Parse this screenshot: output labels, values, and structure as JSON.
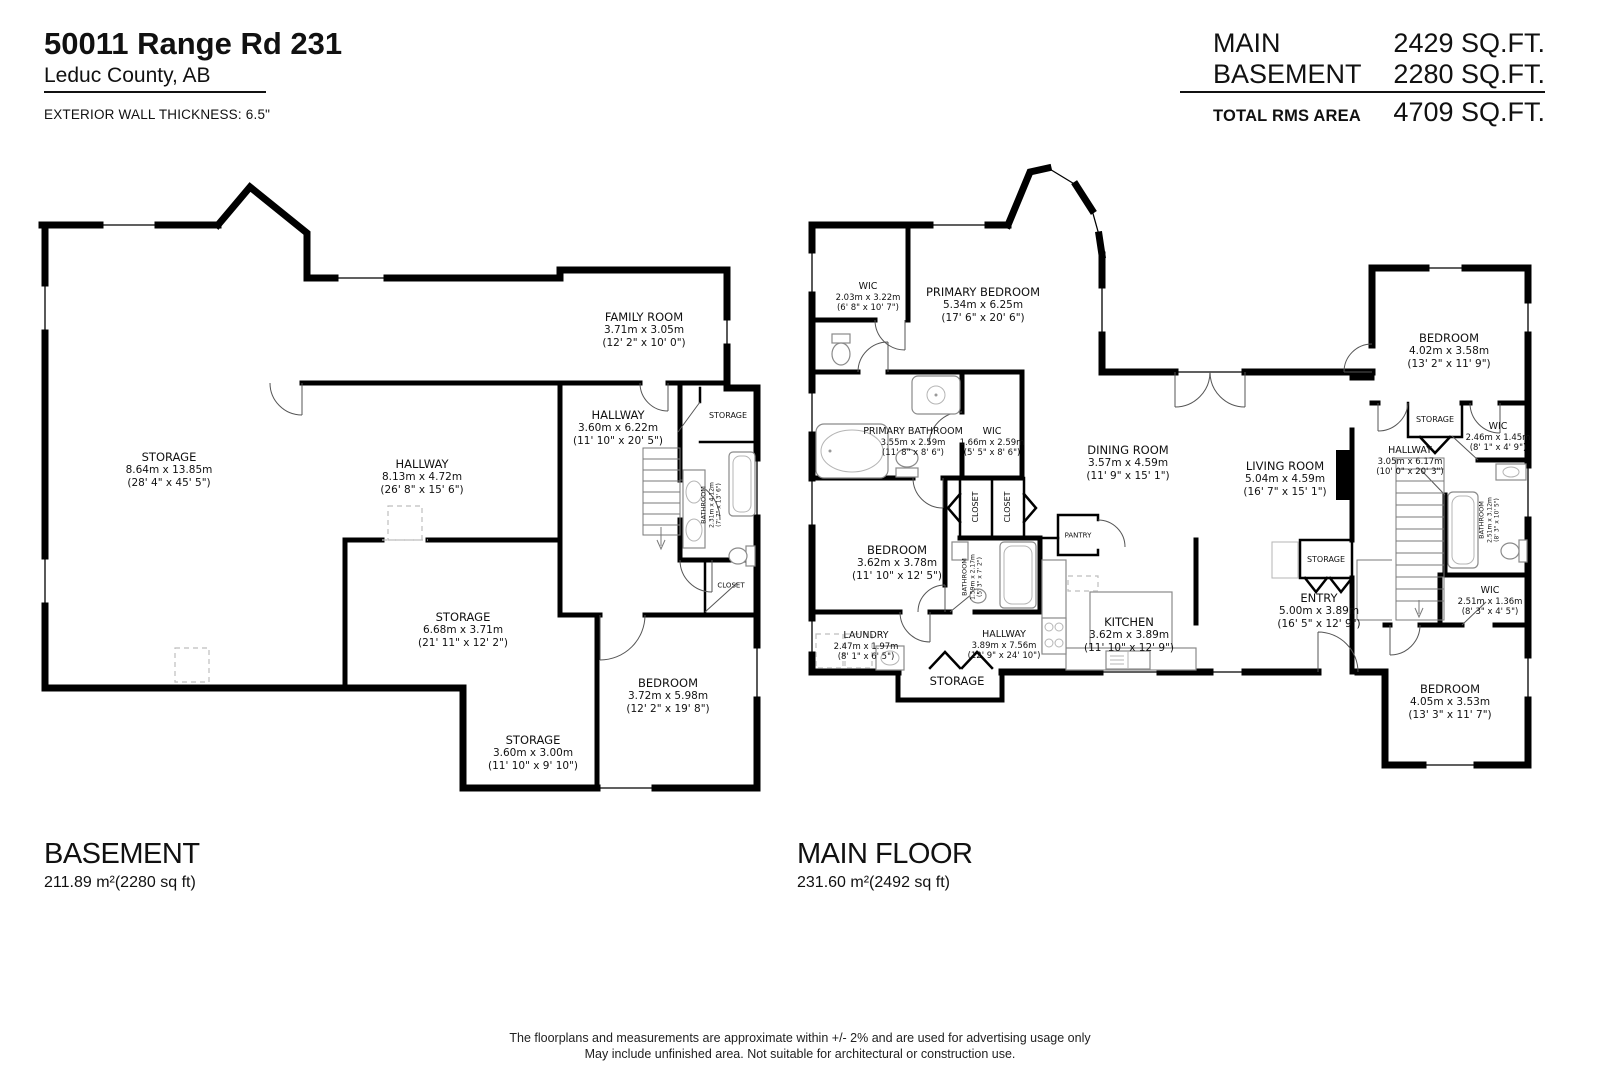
{
  "header": {
    "title": "50011 Range Rd 231",
    "subtitle": "Leduc County, AB",
    "wall_note": "EXTERIOR WALL THICKNESS: 6.5\""
  },
  "area_summary": {
    "rows": [
      {
        "label": "MAIN",
        "value": "2429 SQ.FT."
      },
      {
        "label": "BASEMENT",
        "value": "2280 SQ.FT."
      }
    ],
    "total_label": "TOTAL RMS AREA",
    "total_value": "4709 SQ.FT."
  },
  "basement": {
    "title": "BASEMENT",
    "area": "211.89 m²(2280 sq ft)",
    "rooms": [
      {
        "name": "STORAGE",
        "metric": "8.64m x 13.85m",
        "imperial": "(28' 4\" x 45' 5\")"
      },
      {
        "name": "HALLWAY",
        "metric": "8.13m x 4.72m",
        "imperial": "(26' 8\" x 15' 6\")"
      },
      {
        "name": "FAMILY ROOM",
        "metric": "3.71m x 3.05m",
        "imperial": "(12' 2\" x 10' 0\")"
      },
      {
        "name": "HALLWAY",
        "metric": "3.60m x 6.22m",
        "imperial": "(11' 10\" x 20' 5\")"
      },
      {
        "name": "STORAGE"
      },
      {
        "name": "BATHROOM",
        "metric": "2.31m x 4.12m",
        "imperial": "(7' 7\" x 13' 6\")"
      },
      {
        "name": "CLOSET"
      },
      {
        "name": "STORAGE",
        "metric": "6.68m x 3.71m",
        "imperial": "(21' 11\" x 12' 2\")"
      },
      {
        "name": "BEDROOM",
        "metric": "3.72m x 5.98m",
        "imperial": "(12' 2\" x 19' 8\")"
      },
      {
        "name": "STORAGE",
        "metric": "3.60m x 3.00m",
        "imperial": "(11' 10\" x 9' 10\")"
      }
    ]
  },
  "main_floor": {
    "title": "MAIN FLOOR",
    "area": "231.60 m²(2492 sq ft)",
    "rooms": [
      {
        "name": "WIC",
        "metric": "2.03m x 3.22m",
        "imperial": "(6' 8\" x 10' 7\")"
      },
      {
        "name": "PRIMARY BEDROOM",
        "metric": "5.34m x 6.25m",
        "imperial": "(17' 6\" x 20' 6\")"
      },
      {
        "name": "PRIMARY BATHROOM",
        "metric": "3.55m x 2.59m",
        "imperial": "(11' 8\" x 8' 6\")"
      },
      {
        "name": "WIC",
        "metric": "1.66m x 2.59m",
        "imperial": "(5' 5\" x 8' 6\")"
      },
      {
        "name": "CLOSET"
      },
      {
        "name": "CLOSET"
      },
      {
        "name": "DINING ROOM",
        "metric": "3.57m x 4.59m",
        "imperial": "(11' 9\" x 15' 1\")"
      },
      {
        "name": "LIVING ROOM",
        "metric": "5.04m x 4.59m",
        "imperial": "(16' 7\" x 15' 1\")"
      },
      {
        "name": "PANTRY"
      },
      {
        "name": "BEDROOM",
        "metric": "3.62m x 3.78m",
        "imperial": "(11' 10\" x 12' 5\")"
      },
      {
        "name": "BATHROOM",
        "metric": "1.59m x 2.17m",
        "imperial": "(5' 3\" x 7' 2\")"
      },
      {
        "name": "LAUNDRY",
        "metric": "2.47m x 1.97m",
        "imperial": "(8' 1\" x 6' 5\")"
      },
      {
        "name": "HALLWAY",
        "metric": "3.89m x 7.56m",
        "imperial": "(12' 9\" x 24' 10\")"
      },
      {
        "name": "STORAGE"
      },
      {
        "name": "KITCHEN",
        "metric": "3.62m x 3.89m",
        "imperial": "(11' 10\" x 12' 9\")"
      },
      {
        "name": "ENTRY",
        "metric": "5.00m x 3.89m",
        "imperial": "(16' 5\" x 12' 9\")"
      },
      {
        "name": "STORAGE"
      },
      {
        "name": "BEDROOM",
        "metric": "4.02m x 3.58m",
        "imperial": "(13' 2\" x 11' 9\")"
      },
      {
        "name": "STORAGE"
      },
      {
        "name": "WIC",
        "metric": "2.46m x 1.45m",
        "imperial": "(8' 1\" x 4' 9\")"
      },
      {
        "name": "HALLWAY",
        "metric": "3.05m x 6.17m",
        "imperial": "(10' 0\" x 20' 3\")"
      },
      {
        "name": "BATHROOM",
        "metric": "2.51m x 3.12m",
        "imperial": "(8' 3\" x 10' 5\")"
      },
      {
        "name": "WIC",
        "metric": "2.51m x 1.36m",
        "imperial": "(8' 3\" x 4' 5\")"
      },
      {
        "name": "BEDROOM",
        "metric": "4.05m x 3.53m",
        "imperial": "(13' 3\" x 11' 7\")"
      }
    ]
  },
  "footer": {
    "line1": "The floorplans and measurements are approximate within +/- 2% and are used for advertising usage only",
    "line2": "May include unfinished area. Not suitable for architectural or construction use."
  }
}
